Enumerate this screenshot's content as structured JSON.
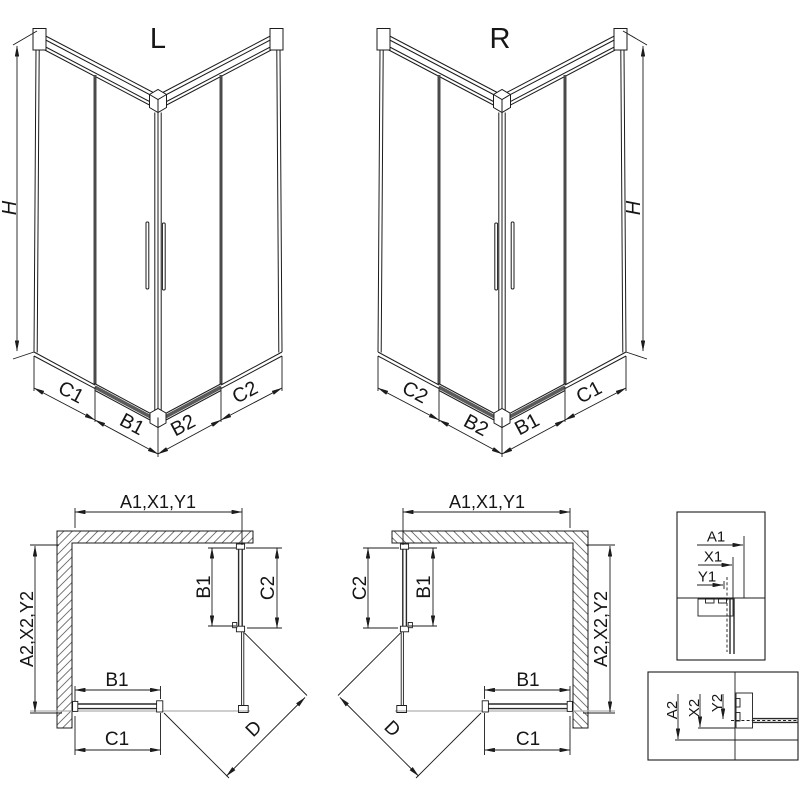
{
  "colors": {
    "line": "#1c1c1c",
    "background": "#ffffff",
    "tray_gray": "#b0b0b0"
  },
  "iso_left": {
    "title": "L",
    "h": "H",
    "c1": "C1",
    "b1": "B1",
    "b2": "B2",
    "c2": "C2"
  },
  "iso_right": {
    "title": "R",
    "h": "H",
    "c2": "C2",
    "b2": "B2",
    "b1": "B1",
    "c1": "C1"
  },
  "plan_left": {
    "width": "A1,X1,Y1",
    "depth": "A2,X2,Y2",
    "door_b1": "B1",
    "panel_c2": "C2",
    "rail_b1": "B1",
    "rail_c1": "C1",
    "diagonal": "D"
  },
  "plan_right": {
    "width": "A1,X1,Y1",
    "depth": "A2,X2,Y2",
    "door_b1": "B1",
    "panel_c2": "C2",
    "rail_b1": "B1",
    "rail_c1": "C1",
    "diagonal": "D"
  },
  "detail_top": {
    "a1": "A1",
    "x1": "X1",
    "y1": "Y1"
  },
  "detail_bottom": {
    "a2": "A2",
    "x2": "X2",
    "y2": "Y2"
  }
}
